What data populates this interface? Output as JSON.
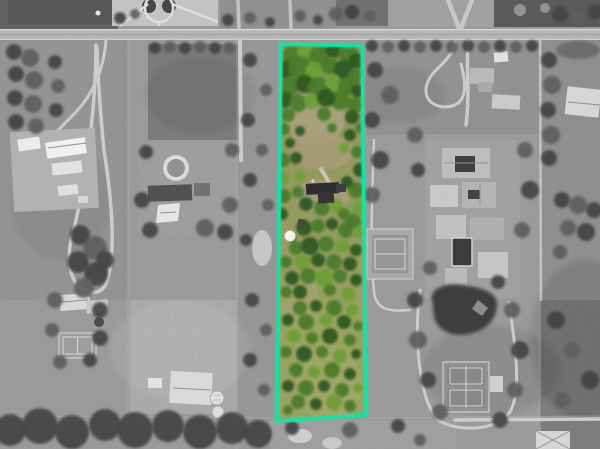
{
  "image": {
    "kind": "aerial-satellite-photo",
    "effect": "grayscale surroundings with one parcel highlighted in natural color and outlined"
  },
  "colors": {
    "parcel-outline": "#15E3A4",
    "background-gray": "#979797",
    "road-gray": "#b4b4b4",
    "parcel-grass": "#93985F",
    "parcel-grass-light": "#A2A96A",
    "parcel-dirt": "#A89C7C",
    "tree-dark-green": "#2E5720",
    "tree-mid-green": "#49792B",
    "tree-light-green": "#6C9C35",
    "house-roof-dark": "#2C2C2F",
    "pond-dark": "#3C3C3C",
    "building-white": "#E9E9E9"
  },
  "parcel": {
    "outline_points": "281,44 362,46 366,415 277,421",
    "features": [
      "dense-tree-canopy-top",
      "main-house-dark-roof",
      "white-dome-structure",
      "open-lawn-with-scattered-trees"
    ]
  },
  "vegetation": {
    "parcel_trees": [
      [
        292,
        56,
        10,
        1
      ],
      [
        306,
        52,
        9,
        2
      ],
      [
        320,
        56,
        11,
        1
      ],
      [
        334,
        50,
        8,
        0
      ],
      [
        348,
        54,
        10,
        1
      ],
      [
        357,
        61,
        8,
        0
      ],
      [
        286,
        70,
        9,
        0
      ],
      [
        300,
        68,
        12,
        1
      ],
      [
        315,
        72,
        10,
        2
      ],
      [
        330,
        66,
        9,
        1
      ],
      [
        344,
        70,
        10,
        0
      ],
      [
        356,
        76,
        8,
        1
      ],
      [
        290,
        86,
        10,
        1
      ],
      [
        305,
        84,
        9,
        0
      ],
      [
        319,
        88,
        11,
        1
      ],
      [
        333,
        82,
        8,
        2
      ],
      [
        347,
        86,
        9,
        1
      ],
      [
        358,
        91,
        7,
        0
      ],
      [
        285,
        100,
        8,
        0
      ],
      [
        298,
        103,
        9,
        1
      ],
      [
        312,
        101,
        8,
        2
      ],
      [
        340,
        100,
        10,
        1
      ],
      [
        355,
        105,
        8,
        1
      ],
      [
        288,
        115,
        7,
        1
      ],
      [
        326,
        98,
        9,
        0
      ],
      [
        324,
        114,
        7,
        1
      ],
      [
        352,
        117,
        7,
        0
      ],
      [
        284,
        129,
        6,
        1
      ],
      [
        300,
        131,
        5,
        0
      ],
      [
        332,
        128,
        5,
        1
      ],
      [
        350,
        135,
        6,
        0
      ],
      [
        360,
        128,
        5,
        1
      ],
      [
        290,
        143,
        5,
        0
      ],
      [
        344,
        148,
        5,
        2
      ],
      [
        283,
        160,
        7,
        1
      ],
      [
        296,
        158,
        6,
        0
      ],
      [
        283,
        178,
        6,
        2
      ],
      [
        284,
        196,
        7,
        1
      ],
      [
        282,
        214,
        6,
        0
      ],
      [
        357,
        152,
        6,
        1
      ],
      [
        360,
        170,
        7,
        0
      ],
      [
        356,
        190,
        8,
        1
      ],
      [
        359,
        208,
        7,
        2
      ],
      [
        353,
        222,
        8,
        1
      ],
      [
        300,
        176,
        5,
        2
      ],
      [
        347,
        182,
        6,
        0
      ],
      [
        298,
        192,
        6,
        1
      ],
      [
        306,
        204,
        7,
        0
      ],
      [
        322,
        208,
        8,
        1
      ],
      [
        336,
        206,
        7,
        2
      ],
      [
        344,
        214,
        6,
        1
      ],
      [
        304,
        228,
        8,
        0
      ],
      [
        318,
        226,
        7,
        1
      ],
      [
        332,
        224,
        6,
        0
      ],
      [
        346,
        230,
        8,
        1
      ],
      [
        358,
        232,
        6,
        2
      ],
      [
        296,
        248,
        7,
        1
      ],
      [
        310,
        246,
        9,
        0
      ],
      [
        326,
        244,
        8,
        1
      ],
      [
        342,
        246,
        7,
        2
      ],
      [
        356,
        250,
        6,
        0
      ],
      [
        286,
        262,
        6,
        1
      ],
      [
        302,
        262,
        8,
        2
      ],
      [
        318,
        260,
        7,
        0
      ],
      [
        334,
        262,
        8,
        1
      ],
      [
        350,
        264,
        7,
        0
      ],
      [
        292,
        278,
        7,
        0
      ],
      [
        308,
        276,
        8,
        1
      ],
      [
        324,
        278,
        9,
        2
      ],
      [
        340,
        276,
        7,
        1
      ],
      [
        356,
        280,
        6,
        0
      ],
      [
        286,
        292,
        6,
        1
      ],
      [
        300,
        292,
        7,
        0
      ],
      [
        330,
        290,
        6,
        1
      ],
      [
        348,
        294,
        7,
        2
      ],
      [
        300,
        308,
        7,
        1
      ],
      [
        316,
        306,
        6,
        0
      ],
      [
        334,
        308,
        8,
        1
      ],
      [
        352,
        310,
        6,
        2
      ],
      [
        288,
        320,
        6,
        0
      ],
      [
        306,
        322,
        8,
        1
      ],
      [
        326,
        320,
        6,
        2
      ],
      [
        344,
        322,
        7,
        0
      ],
      [
        358,
        326,
        5,
        1
      ],
      [
        294,
        336,
        7,
        2
      ],
      [
        312,
        338,
        6,
        1
      ],
      [
        330,
        336,
        8,
        0
      ],
      [
        350,
        340,
        6,
        1
      ],
      [
        286,
        352,
        6,
        1
      ],
      [
        304,
        354,
        8,
        0
      ],
      [
        322,
        352,
        6,
        1
      ],
      [
        340,
        356,
        7,
        2
      ],
      [
        356,
        354,
        5,
        0
      ],
      [
        296,
        370,
        7,
        1
      ],
      [
        314,
        372,
        6,
        2
      ],
      [
        332,
        370,
        8,
        1
      ],
      [
        350,
        374,
        6,
        0
      ],
      [
        288,
        386,
        6,
        0
      ],
      [
        306,
        388,
        8,
        1
      ],
      [
        324,
        386,
        6,
        0
      ],
      [
        342,
        390,
        7,
        1
      ],
      [
        358,
        388,
        5,
        2
      ],
      [
        298,
        402,
        7,
        1
      ],
      [
        316,
        404,
        6,
        0
      ],
      [
        334,
        402,
        8,
        2
      ],
      [
        350,
        406,
        6,
        1
      ],
      [
        288,
        410,
        5,
        1
      ]
    ],
    "gray_trees": [
      [
        14,
        52,
        8,
        0
      ],
      [
        30,
        58,
        9,
        1
      ],
      [
        16,
        74,
        8,
        0
      ],
      [
        34,
        80,
        9,
        1
      ],
      [
        15,
        98,
        8,
        0
      ],
      [
        33,
        104,
        9,
        1
      ],
      [
        16,
        122,
        8,
        0
      ],
      [
        36,
        126,
        8,
        1
      ],
      [
        55,
        62,
        7,
        0
      ],
      [
        58,
        86,
        7,
        1
      ],
      [
        56,
        110,
        7,
        0
      ],
      [
        80,
        235,
        10,
        0
      ],
      [
        95,
        248,
        12,
        1
      ],
      [
        78,
        262,
        11,
        0
      ],
      [
        96,
        274,
        12,
        0
      ],
      [
        84,
        288,
        10,
        1
      ],
      [
        105,
        260,
        9,
        0
      ],
      [
        155,
        48,
        6,
        0
      ],
      [
        170,
        47,
        6,
        1
      ],
      [
        185,
        48,
        6,
        0
      ],
      [
        200,
        47,
        6,
        1
      ],
      [
        215,
        48,
        6,
        0
      ],
      [
        229,
        48,
        6,
        1
      ],
      [
        146,
        152,
        7,
        0
      ],
      [
        232,
        150,
        7,
        1
      ],
      [
        142,
        200,
        8,
        0
      ],
      [
        230,
        205,
        8,
        1
      ],
      [
        150,
        230,
        8,
        0
      ],
      [
        205,
        228,
        9,
        1
      ],
      [
        225,
        232,
        8,
        0
      ],
      [
        10,
        430,
        16,
        0
      ],
      [
        40,
        426,
        18,
        0
      ],
      [
        72,
        432,
        17,
        0
      ],
      [
        105,
        425,
        16,
        0
      ],
      [
        135,
        430,
        18,
        0
      ],
      [
        168,
        426,
        16,
        0
      ],
      [
        200,
        432,
        17,
        0
      ],
      [
        232,
        428,
        16,
        0
      ],
      [
        258,
        434,
        14,
        0
      ],
      [
        55,
        300,
        8,
        1
      ],
      [
        100,
        310,
        8,
        0
      ],
      [
        52,
        330,
        7,
        1
      ],
      [
        100,
        338,
        8,
        0
      ],
      [
        60,
        362,
        7,
        1
      ],
      [
        90,
        360,
        7,
        0
      ],
      [
        250,
        60,
        7,
        0
      ],
      [
        266,
        90,
        6,
        1
      ],
      [
        248,
        120,
        7,
        0
      ],
      [
        262,
        150,
        6,
        1
      ],
      [
        250,
        180,
        7,
        0
      ],
      [
        268,
        205,
        6,
        1
      ],
      [
        252,
        300,
        7,
        0
      ],
      [
        266,
        330,
        6,
        1
      ],
      [
        250,
        360,
        7,
        0
      ],
      [
        264,
        390,
        6,
        1
      ],
      [
        246,
        240,
        6,
        0
      ],
      [
        372,
        46,
        6,
        0
      ],
      [
        388,
        47,
        6,
        1
      ],
      [
        404,
        46,
        6,
        0
      ],
      [
        420,
        47,
        6,
        1
      ],
      [
        436,
        46,
        6,
        0
      ],
      [
        452,
        47,
        6,
        1
      ],
      [
        468,
        46,
        6,
        0
      ],
      [
        484,
        47,
        6,
        1
      ],
      [
        500,
        46,
        6,
        0
      ],
      [
        516,
        47,
        6,
        1
      ],
      [
        532,
        46,
        6,
        0
      ],
      [
        375,
        70,
        8,
        0
      ],
      [
        390,
        95,
        9,
        1
      ],
      [
        372,
        120,
        8,
        0
      ],
      [
        415,
        135,
        8,
        1
      ],
      [
        380,
        160,
        9,
        0
      ],
      [
        372,
        195,
        8,
        1
      ],
      [
        418,
        170,
        7,
        0
      ],
      [
        525,
        150,
        8,
        1
      ],
      [
        530,
        190,
        9,
        0
      ],
      [
        522,
        230,
        8,
        1
      ],
      [
        415,
        300,
        8,
        0
      ],
      [
        418,
        340,
        9,
        1
      ],
      [
        428,
        380,
        8,
        0
      ],
      [
        440,
        412,
        8,
        1
      ],
      [
        500,
        420,
        8,
        0
      ],
      [
        515,
        390,
        8,
        1
      ],
      [
        520,
        350,
        9,
        0
      ],
      [
        512,
        310,
        8,
        1
      ],
      [
        498,
        282,
        7,
        0
      ],
      [
        430,
        268,
        7,
        1
      ],
      [
        549,
        60,
        8,
        0
      ],
      [
        552,
        85,
        9,
        1
      ],
      [
        548,
        110,
        8,
        0
      ],
      [
        551,
        135,
        9,
        1
      ],
      [
        549,
        158,
        8,
        0
      ],
      [
        562,
        200,
        8,
        0
      ],
      [
        578,
        205,
        9,
        1
      ],
      [
        594,
        210,
        8,
        0
      ],
      [
        568,
        228,
        8,
        1
      ],
      [
        586,
        232,
        9,
        0
      ],
      [
        560,
        252,
        7,
        1
      ],
      [
        556,
        320,
        9,
        0
      ],
      [
        572,
        350,
        8,
        1
      ],
      [
        590,
        380,
        9,
        0
      ],
      [
        562,
        400,
        8,
        1
      ],
      [
        292,
        428,
        7,
        0
      ],
      [
        350,
        430,
        8,
        1
      ],
      [
        398,
        426,
        7,
        0
      ],
      [
        420,
        440,
        6,
        1
      ],
      [
        228,
        20,
        6,
        0
      ],
      [
        250,
        18,
        6,
        1
      ],
      [
        270,
        22,
        5,
        0
      ],
      [
        300,
        16,
        6,
        1
      ],
      [
        318,
        20,
        5,
        0
      ],
      [
        336,
        14,
        7,
        1
      ],
      [
        352,
        12,
        7,
        0
      ],
      [
        370,
        16,
        6,
        1
      ],
      [
        120,
        18,
        6,
        0
      ],
      [
        135,
        14,
        5,
        1
      ],
      [
        560,
        14,
        8,
        0
      ],
      [
        578,
        18,
        7,
        1
      ],
      [
        595,
        12,
        7,
        0
      ]
    ]
  }
}
